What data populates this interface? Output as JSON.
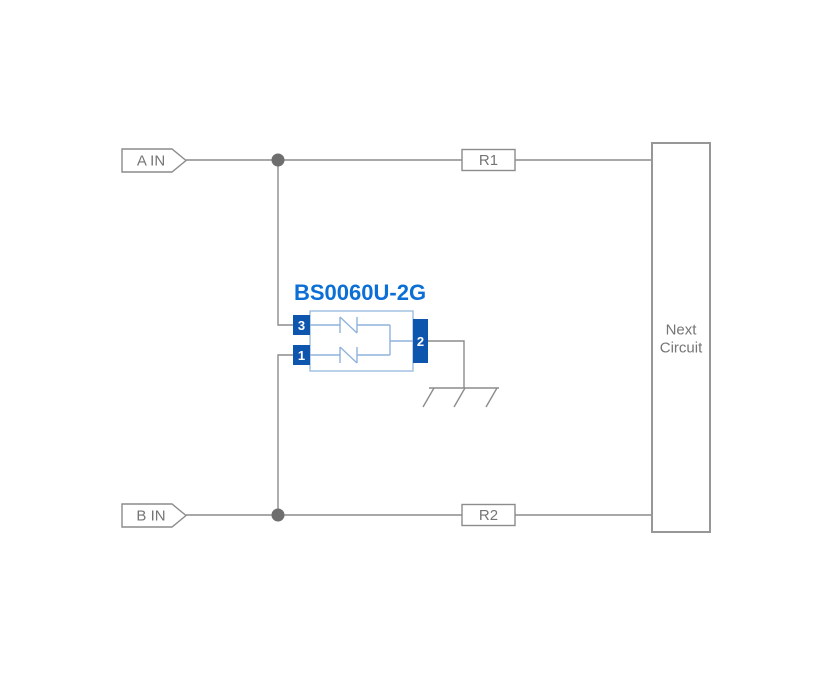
{
  "colors": {
    "wire_gray": "#8c8c8c",
    "label_text_gray": "#757575",
    "junction_dot_gray": "#6e6e6e",
    "pin_blue": "#0d55ad",
    "component_title_blue": "#0b6fd6",
    "component_outline_light_blue": "#9dbde2"
  },
  "diagram": {
    "component_title": "BS0060U-2G",
    "input_a": {
      "label": "A IN"
    },
    "input_b": {
      "label": "B IN"
    },
    "resistor_r1": {
      "label": "R1"
    },
    "resistor_r2": {
      "label": "R2"
    },
    "pin_3": {
      "label": "3"
    },
    "pin_1": {
      "label": "1"
    },
    "pin_2": {
      "label": "2"
    },
    "next_circuit": {
      "line1": "Next",
      "line2": "Circuit"
    }
  }
}
